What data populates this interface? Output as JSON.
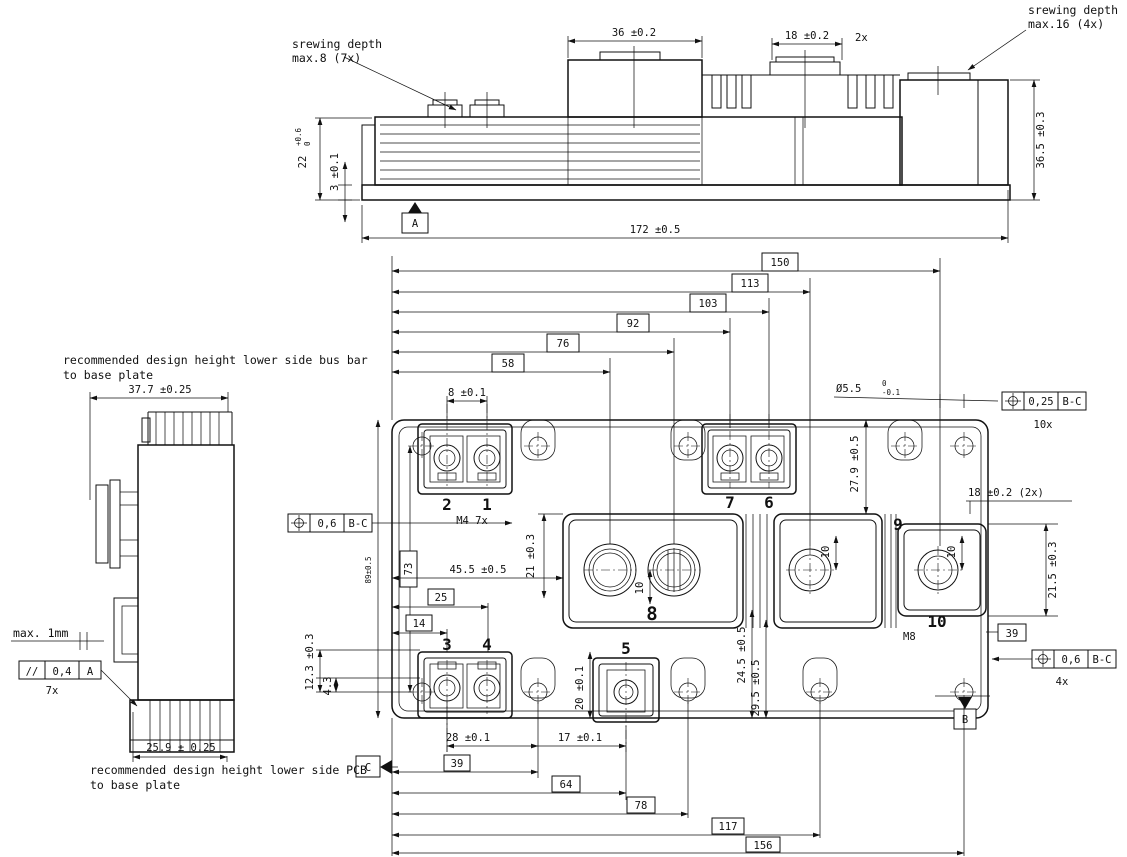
{
  "notes": {
    "screw_small_l1": "srewing depth",
    "screw_small_l2": "max.8   (7x)",
    "screw_large_l1": "srewing depth",
    "screw_large_l2": "max.16 (4x)",
    "busbar_l1": "recommended design height lower side bus bar",
    "busbar_l2": "to base plate",
    "pcb_l1": "recommended design height lower side PCB",
    "pcb_l2": "to base plate",
    "max_gap": "max. 1mm"
  },
  "top_view": {
    "dim_block_width": "36 ±0.2",
    "dim_boss_width": "18 ±0.2",
    "boss_qty": "2x",
    "dim_fin_height": "22",
    "fin_tol_up": "+0.6",
    "fin_tol_dn": "0",
    "dim_base_thk": "3 ±0.1",
    "dim_total_height": "36.5 ±0.3",
    "dim_total_length": "172 ±0.5",
    "datum_a": "A"
  },
  "plan_view": {
    "chain_top": {
      "d58": "58",
      "d76": "76",
      "d92": "92",
      "d103": "103",
      "d113": "113",
      "d150": "150"
    },
    "chain_bottom": {
      "d39": "39",
      "d64": "64",
      "d78": "78",
      "d117": "117",
      "d156": "156"
    },
    "dim_8": "8 ±0.1",
    "m4": "M4  7x",
    "m8": "M8",
    "terminals": {
      "t1": "1",
      "t2": "2",
      "t3": "3",
      "t4": "4",
      "t5": "5",
      "t6": "6",
      "t7": "7",
      "t8": "8",
      "t9": "9",
      "t10": "10"
    },
    "dim_455": "45.5 ±0.5",
    "dim_21": "21 ±0.3",
    "dim_10_8": "10",
    "dim_10_9": "10",
    "dim_10_10": "10",
    "boxed_25": "25",
    "boxed_14": "14",
    "dim_89": "89±0.5",
    "boxed_73": "73",
    "dim_123": "12.3 ±0.3",
    "dim_43": "4.3",
    "dim_28": "28 ±0.1",
    "dim_17": "17 ±0.1",
    "dim_20": "20 ±0.1",
    "dim_245": "24.5 ±0.5",
    "dim_295": "29.5 ±0.5",
    "dim_279": "27.9 ±0.5",
    "dim_18_2x": "18 ±0.2  (2x)",
    "dim_215": "21.5 ±0.3",
    "boxed_39_right": "39",
    "dia_hole": "Ø5.5",
    "dia_tol_up": "0",
    "dia_tol_dn": "-0.1",
    "fcf_holes": {
      "val": "0,25",
      "ref": "B-C",
      "qty": "10x"
    },
    "fcf_left": {
      "val": "0,6",
      "ref": "B-C"
    },
    "fcf_right": {
      "val": "0,6",
      "ref": "B-C",
      "qty": "4x"
    },
    "datum_b": "B",
    "datum_c": "C"
  },
  "side_view": {
    "dim_width_top": "37.7 ±0.25",
    "dim_width_bottom": "25.9 ± 0.25",
    "fcf_parallel": {
      "sym": "//",
      "val": "0,4",
      "ref": "A",
      "qty": "7x"
    }
  }
}
